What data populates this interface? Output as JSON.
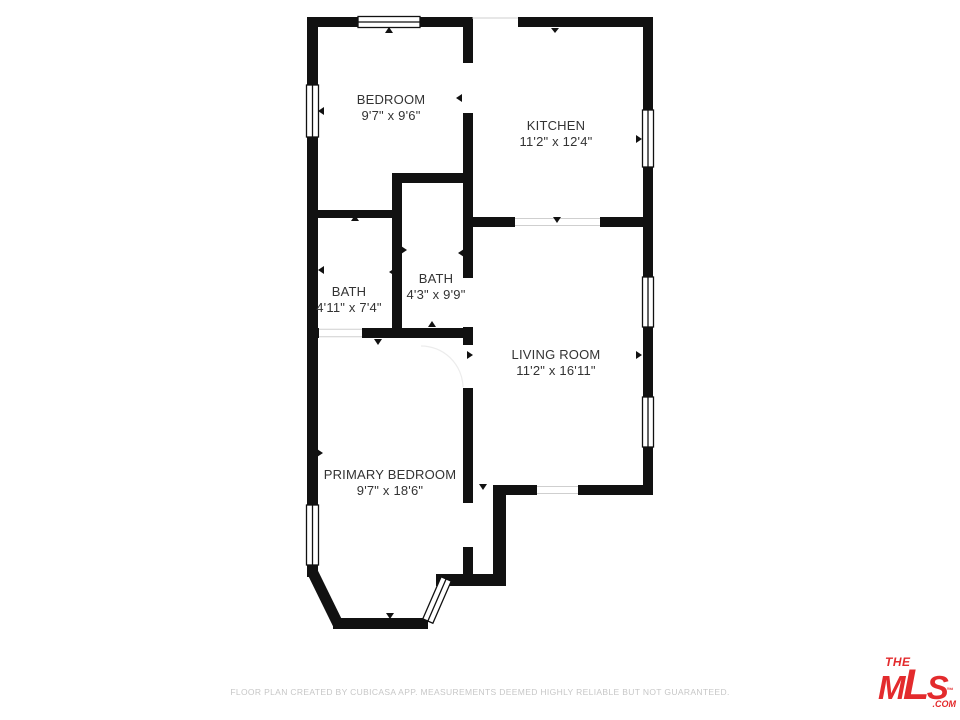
{
  "floor_plan": {
    "rooms": [
      {
        "id": "bedroom",
        "name": "BEDROOM",
        "dimensions": "9'7\" x 9'6\""
      },
      {
        "id": "kitchen",
        "name": "KITCHEN",
        "dimensions": "11'2\" x 12'4\""
      },
      {
        "id": "bath-center",
        "name": "BATH",
        "dimensions": "4'3\" x 9'9\""
      },
      {
        "id": "bath-left",
        "name": "BATH",
        "dimensions": "4'11\" x 7'4\""
      },
      {
        "id": "living-room",
        "name": "LIVING ROOM",
        "dimensions": "11'2\" x 16'11\""
      },
      {
        "id": "primary-bedroom",
        "name": "PRIMARY BEDROOM",
        "dimensions": "9'7\" x 18'6\""
      }
    ],
    "wall_color": "#111111",
    "label_color": "#333333"
  },
  "footer": {
    "disclaimer": "FLOOR PLAN CREATED BY CUBICASA APP. MEASUREMENTS DEEMED HIGHLY RELIABLE BUT NOT GUARANTEED.",
    "color": "#c7c7c7"
  },
  "logo": {
    "the": "THE",
    "m": "M",
    "l": "L",
    "s": "S",
    "tm": "™",
    "com": ".COM",
    "color": "#e32b2d"
  }
}
